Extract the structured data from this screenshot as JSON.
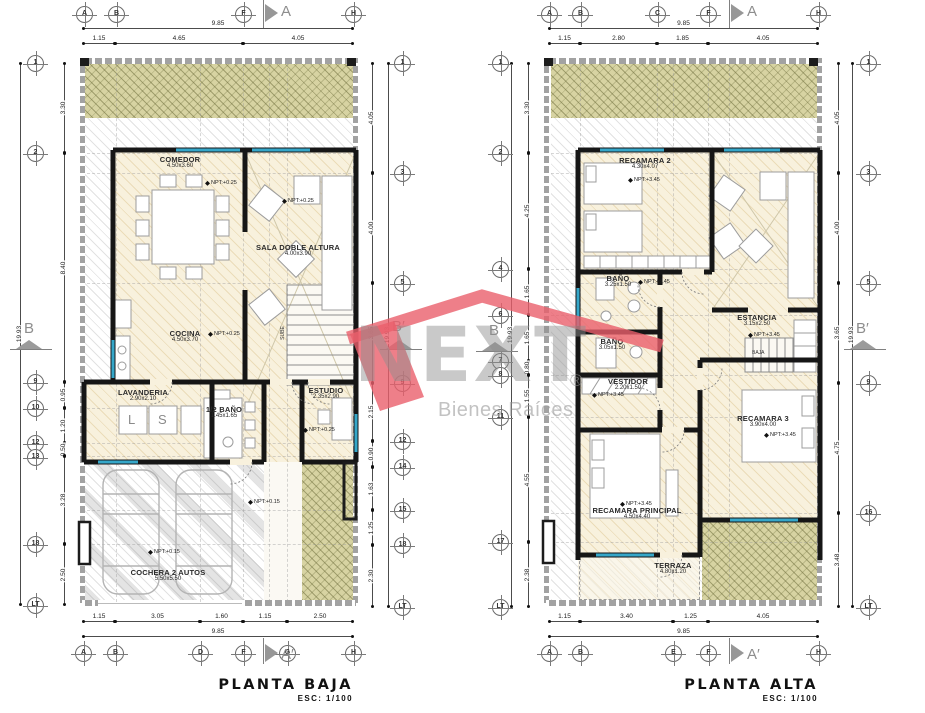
{
  "watermark": {
    "brand": "NEXT",
    "registered": "®",
    "tagline": "Bienes Raíces",
    "roof_color": "#ea5f6b"
  },
  "plans": [
    {
      "title": "PLANTA BAJA",
      "scale": "ESC: 1/100",
      "section_labels": {
        "top": "A",
        "bottom": "A′",
        "left": "B",
        "right": "B′"
      },
      "grid_top": [
        "A",
        "B",
        "F",
        "H"
      ],
      "grid_bottom": [
        "A",
        "B",
        "D",
        "F",
        "G",
        "H"
      ],
      "grid_left": [
        "1",
        "2",
        "9",
        "10",
        "12",
        "13",
        "18",
        "LT"
      ],
      "grid_right": [
        "1",
        "3",
        "5",
        "9",
        "12",
        "14",
        "15",
        "18",
        "LT"
      ],
      "dims_top": [
        "1.15",
        "4.65",
        "4.05"
      ],
      "dims_top_total": "9.85",
      "dims_bottom": [
        "1.15",
        "3.05",
        "1.60",
        "1.15",
        "2.50"
      ],
      "dims_bottom_total": "9.85",
      "dims_left": [
        "3.30",
        "8.40",
        "0.95",
        "1.20",
        "0.50",
        "3.28",
        "2.50"
      ],
      "dims_left_total": "19.93",
      "dims_right": [
        "4.05",
        "4.00",
        "3.65",
        "2.15",
        "0.90",
        "1.63",
        "1.25",
        "2.30"
      ],
      "dims_right_total": "19.93",
      "rooms": [
        {
          "name": "COMEDOR",
          "size": "4.50x3.60"
        },
        {
          "name": "SALA DOBLE ALTURA",
          "size": "4.00x3.90"
        },
        {
          "name": "COCINA",
          "size": "4.50x3.70"
        },
        {
          "name": "LAVANDERIA",
          "size": "2.90x2.10"
        },
        {
          "name": "1/2 BAÑO",
          "size": "1.45x1.65"
        },
        {
          "name": "ESTUDIO",
          "size": "2.35x2.90"
        },
        {
          "name": "COCHERA 2 AUTOS",
          "size": "5.50x5.50"
        }
      ],
      "npt": [
        "NPT:+0.25",
        "NPT:+0.25",
        "NPT:+0.25",
        "NPT:+0.25",
        "NPT:+0.15",
        "NPT:+0.15"
      ],
      "stair_label": "SUBE",
      "appliances": {
        "washer": "L",
        "dryer": "S"
      }
    },
    {
      "title": "PLANTA ALTA",
      "scale": "ESC: 1/100",
      "section_labels": {
        "top": "A",
        "bottom": "A′",
        "left": "B",
        "right": "B′"
      },
      "grid_top": [
        "A",
        "B",
        "C",
        "F",
        "H"
      ],
      "grid_bottom": [
        "A",
        "B",
        "E",
        "F",
        "H"
      ],
      "grid_left": [
        "1",
        "2",
        "4",
        "6",
        "7",
        "8",
        "11",
        "17",
        "LT"
      ],
      "grid_right": [
        "1",
        "3",
        "5",
        "9",
        "16",
        "LT"
      ],
      "dims_top": [
        "1.15",
        "2.80",
        "1.85",
        "4.05"
      ],
      "dims_top_total": "9.85",
      "dims_bottom": [
        "1.15",
        "3.40",
        "1.25",
        "4.05"
      ],
      "dims_bottom_total": "9.85",
      "dims_left": [
        "3.30",
        "4.25",
        "1.65",
        "1.65",
        "0.80",
        "1.55",
        "4.55",
        "2.38"
      ],
      "dims_left_total": "19.93",
      "dims_right": [
        "4.05",
        "4.00",
        "3.65",
        "4.75",
        "3.48"
      ],
      "dims_right_total": "19.93",
      "rooms": [
        {
          "name": "RECAMARA 2",
          "size": "4.30x4.07"
        },
        {
          "name": "BAÑO",
          "size": "3.25x1.50"
        },
        {
          "name": "ESTANCIA",
          "size": "3.15x2.50"
        },
        {
          "name": "BAÑO",
          "size": "3.05x1.50"
        },
        {
          "name": "VESTIDOR",
          "size": "2.20x1.50"
        },
        {
          "name": "RECAMARA 3",
          "size": "3.90x4.00"
        },
        {
          "name": "RECAMARA PRINCIPAL",
          "size": "4.50x4.40"
        },
        {
          "name": "TERRAZA",
          "size": "4.80x1.20"
        }
      ],
      "npt": [
        "NPT:+3.45",
        "NPT:+3.45",
        "NPT:+3.45",
        "NPT:+3.45",
        "NPT:+3.45",
        "NPT:+3.45"
      ],
      "stair_label": "BAJA"
    }
  ]
}
